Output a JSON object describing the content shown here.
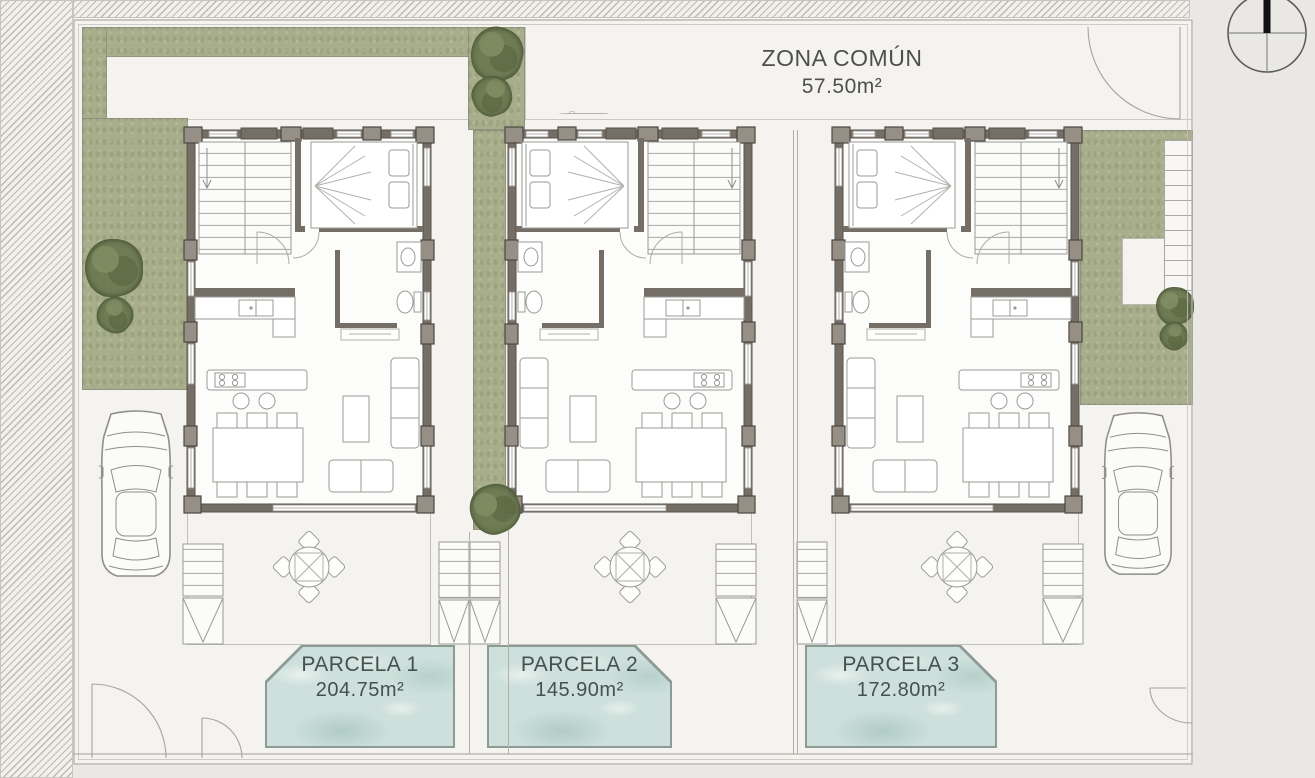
{
  "zona_comun": {
    "label": "ZONA COMÚN",
    "area": "57.50m²"
  },
  "parcels": [
    {
      "name": "PARCELA 1",
      "area": "204.75m²"
    },
    {
      "name": "PARCELA 2",
      "area": "145.90m²"
    },
    {
      "name": "PARCELA 3",
      "area": "172.80m²"
    }
  ],
  "icons": {
    "north": "compass-icon",
    "car": "car-icon",
    "tree": "tree-icon",
    "stairs": "stairs-icon",
    "gate": "gate-arc-icon"
  },
  "colors": {
    "outside_bg": "#eae8e5",
    "site_bg": "#f4f3f0",
    "grass": "#a8ae8b",
    "tree": "#6d7a52",
    "pool_water": "#cde0db",
    "pool_rim": "#8d9b97",
    "wall": "#756e66",
    "pillar": "#968f85",
    "text": "#4f4f4f",
    "pool_text": "#45504f",
    "north_needle": "#111111"
  }
}
